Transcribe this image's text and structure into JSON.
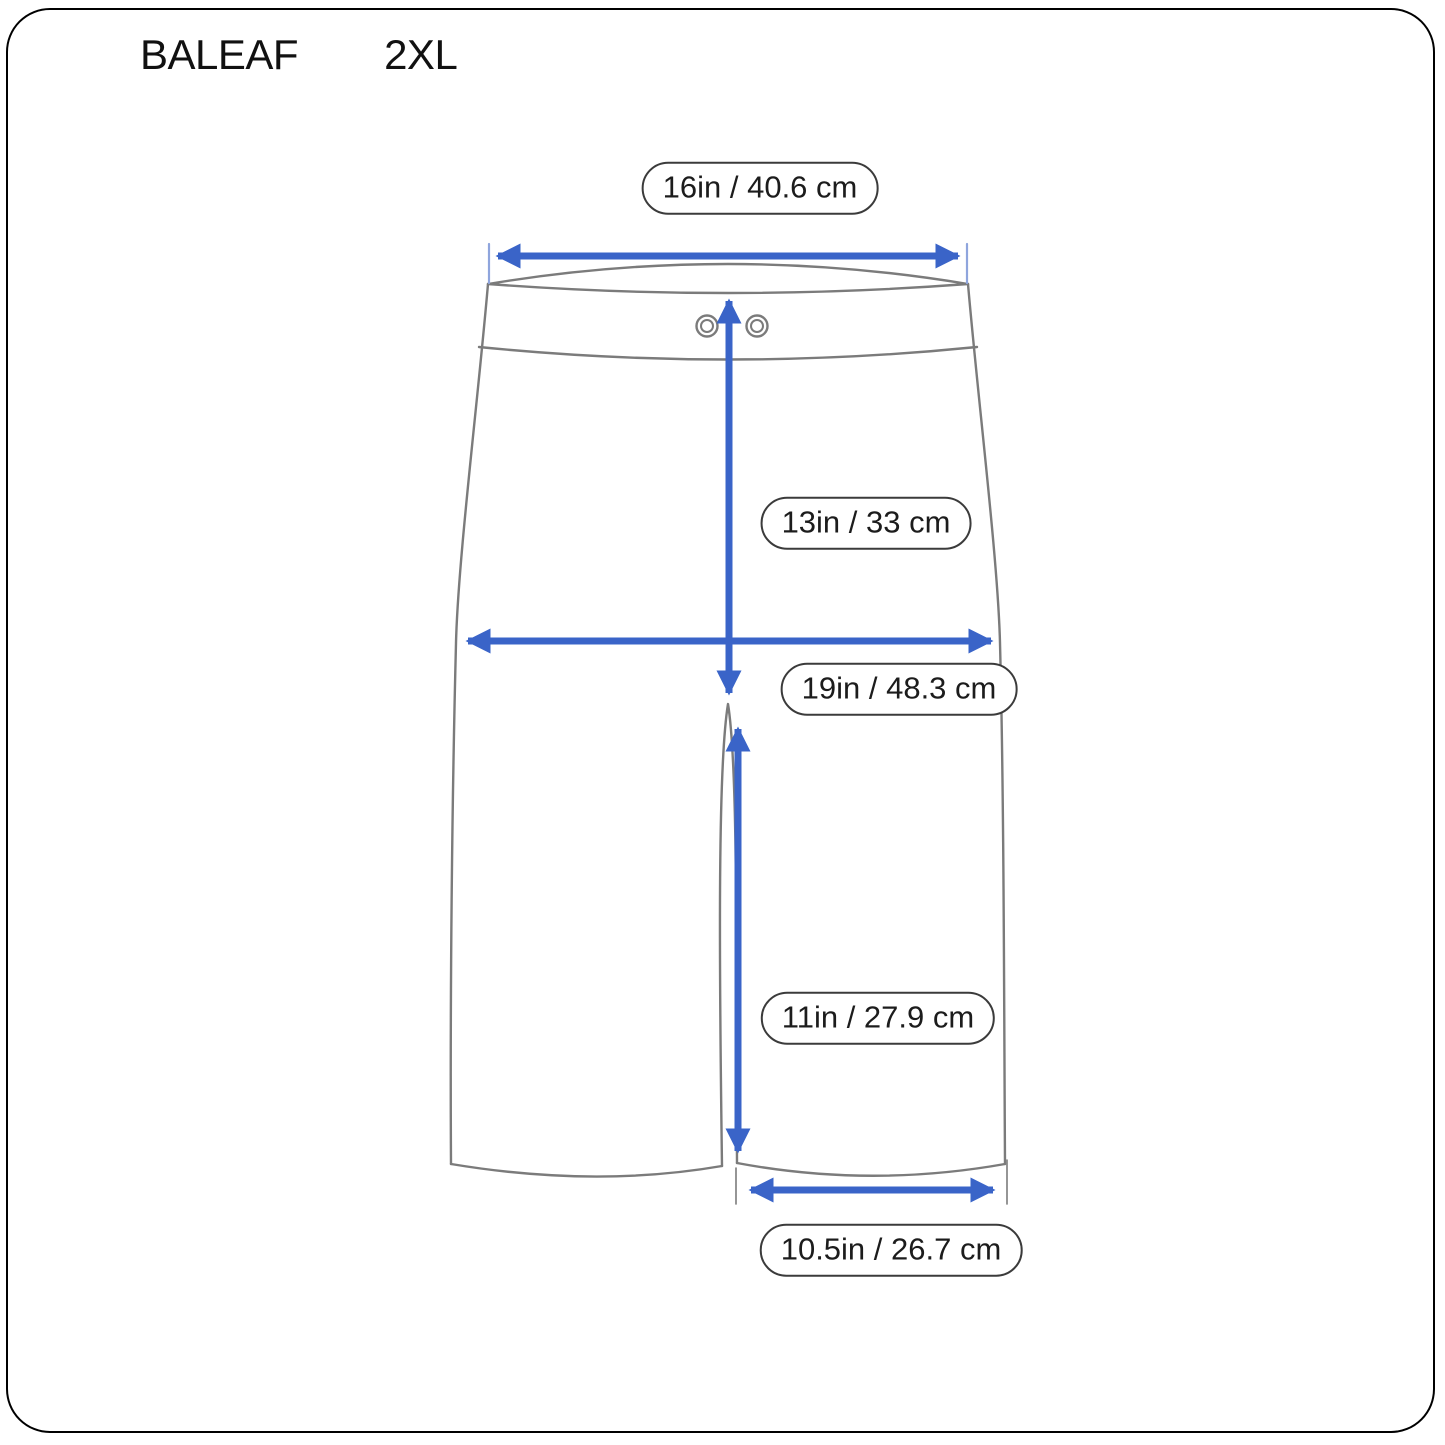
{
  "header": {
    "brand": "BALEAF",
    "size": "2XL"
  },
  "diagram": {
    "type": "garment-measurement-diagram",
    "garment": "shorts-front-view",
    "colors": {
      "arrow": "#3a64c8",
      "tick": "#8fa5dd",
      "outline": "#7b7b7b",
      "pill_border": "#3b3b3b",
      "text": "#1c1c1c",
      "frame": "#000000",
      "background": "#ffffff"
    },
    "measurements": [
      {
        "id": "waist-width",
        "label": "16in / 40.6 cm"
      },
      {
        "id": "front-rise",
        "label": "13in / 33 cm"
      },
      {
        "id": "hip-width",
        "label": "19in / 48.3 cm"
      },
      {
        "id": "inseam",
        "label": "11in / 27.9 cm"
      },
      {
        "id": "leg-opening",
        "label": "10.5in / 26.7 cm"
      }
    ]
  }
}
